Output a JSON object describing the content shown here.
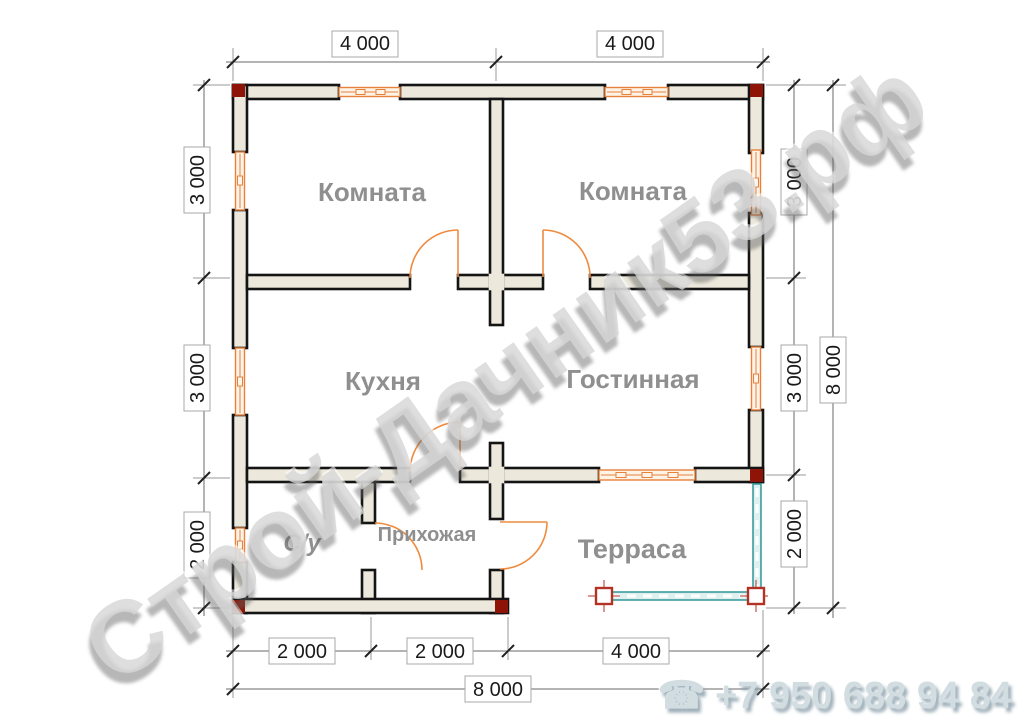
{
  "watermark": {
    "text": "Строй-Дачник53.рф"
  },
  "phone": {
    "icon": "☎",
    "number": "+7 950 688 94 84"
  },
  "rooms": {
    "bedroom1": "Комната",
    "bedroom2": "Комната",
    "kitchen": "Кухня",
    "living": "Гостинная",
    "bathroom": "С/у",
    "hallway": "Прихожая",
    "terrace": "Терраса"
  },
  "dimensions": {
    "top": [
      "4 000",
      "4 000"
    ],
    "left": [
      "3 000",
      "3 000",
      "2 000"
    ],
    "right": [
      "3 000",
      "3 000",
      "2 000"
    ],
    "bottom": [
      "2 000",
      "2 000",
      "4 000"
    ],
    "total_width": "8 000",
    "total_height": "8 000"
  },
  "colors": {
    "wall_fill": "#ece8dc",
    "wall_stroke": "#141414",
    "window_frame": "#e8813c",
    "door_arc": "#ef8b3f",
    "terrace_rail": "#3d9c9c",
    "corner_marker": "#8e1408",
    "room_label": "#8f8f8f",
    "watermark_gray": "#d6d6d6",
    "phone_gray": "#d2dde1"
  }
}
